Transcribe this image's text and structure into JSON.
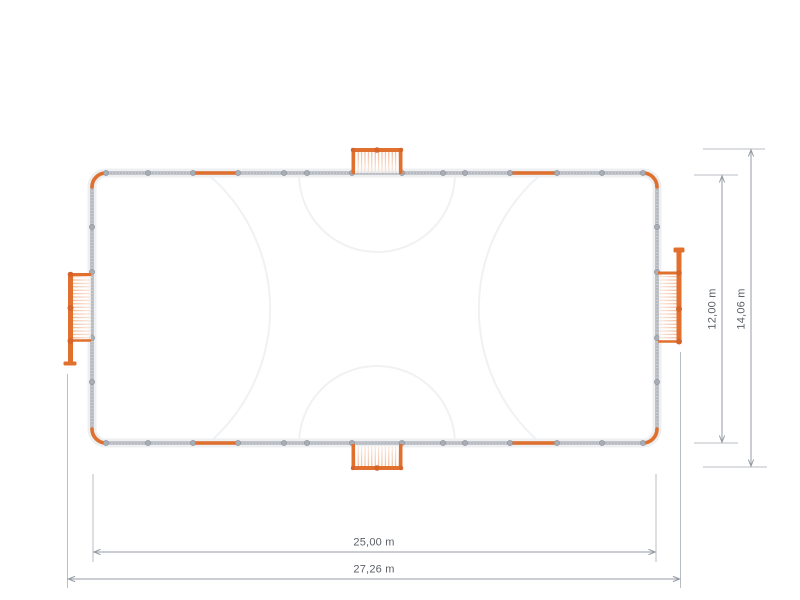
{
  "diagram": {
    "name": "soccer-court-top-view-plan",
    "dimensions": {
      "court_length": "25,00 m",
      "overall_length": "27,26 m",
      "court_width": "12,00 m",
      "overall_width": "14,06 m"
    },
    "colors": {
      "goal_orange": "#E1702F",
      "goal_node_orange": "#D4642A",
      "wall_gray": "#B5B9C0",
      "post_gray": "#9CA2AA",
      "dimension_line_gray": "#949BA3",
      "extension_line_gray": "#B9BEC5",
      "court_marking_gray": "#F0F1F3",
      "label_gray": "#5C6167",
      "background": "#FFFFFF"
    }
  }
}
